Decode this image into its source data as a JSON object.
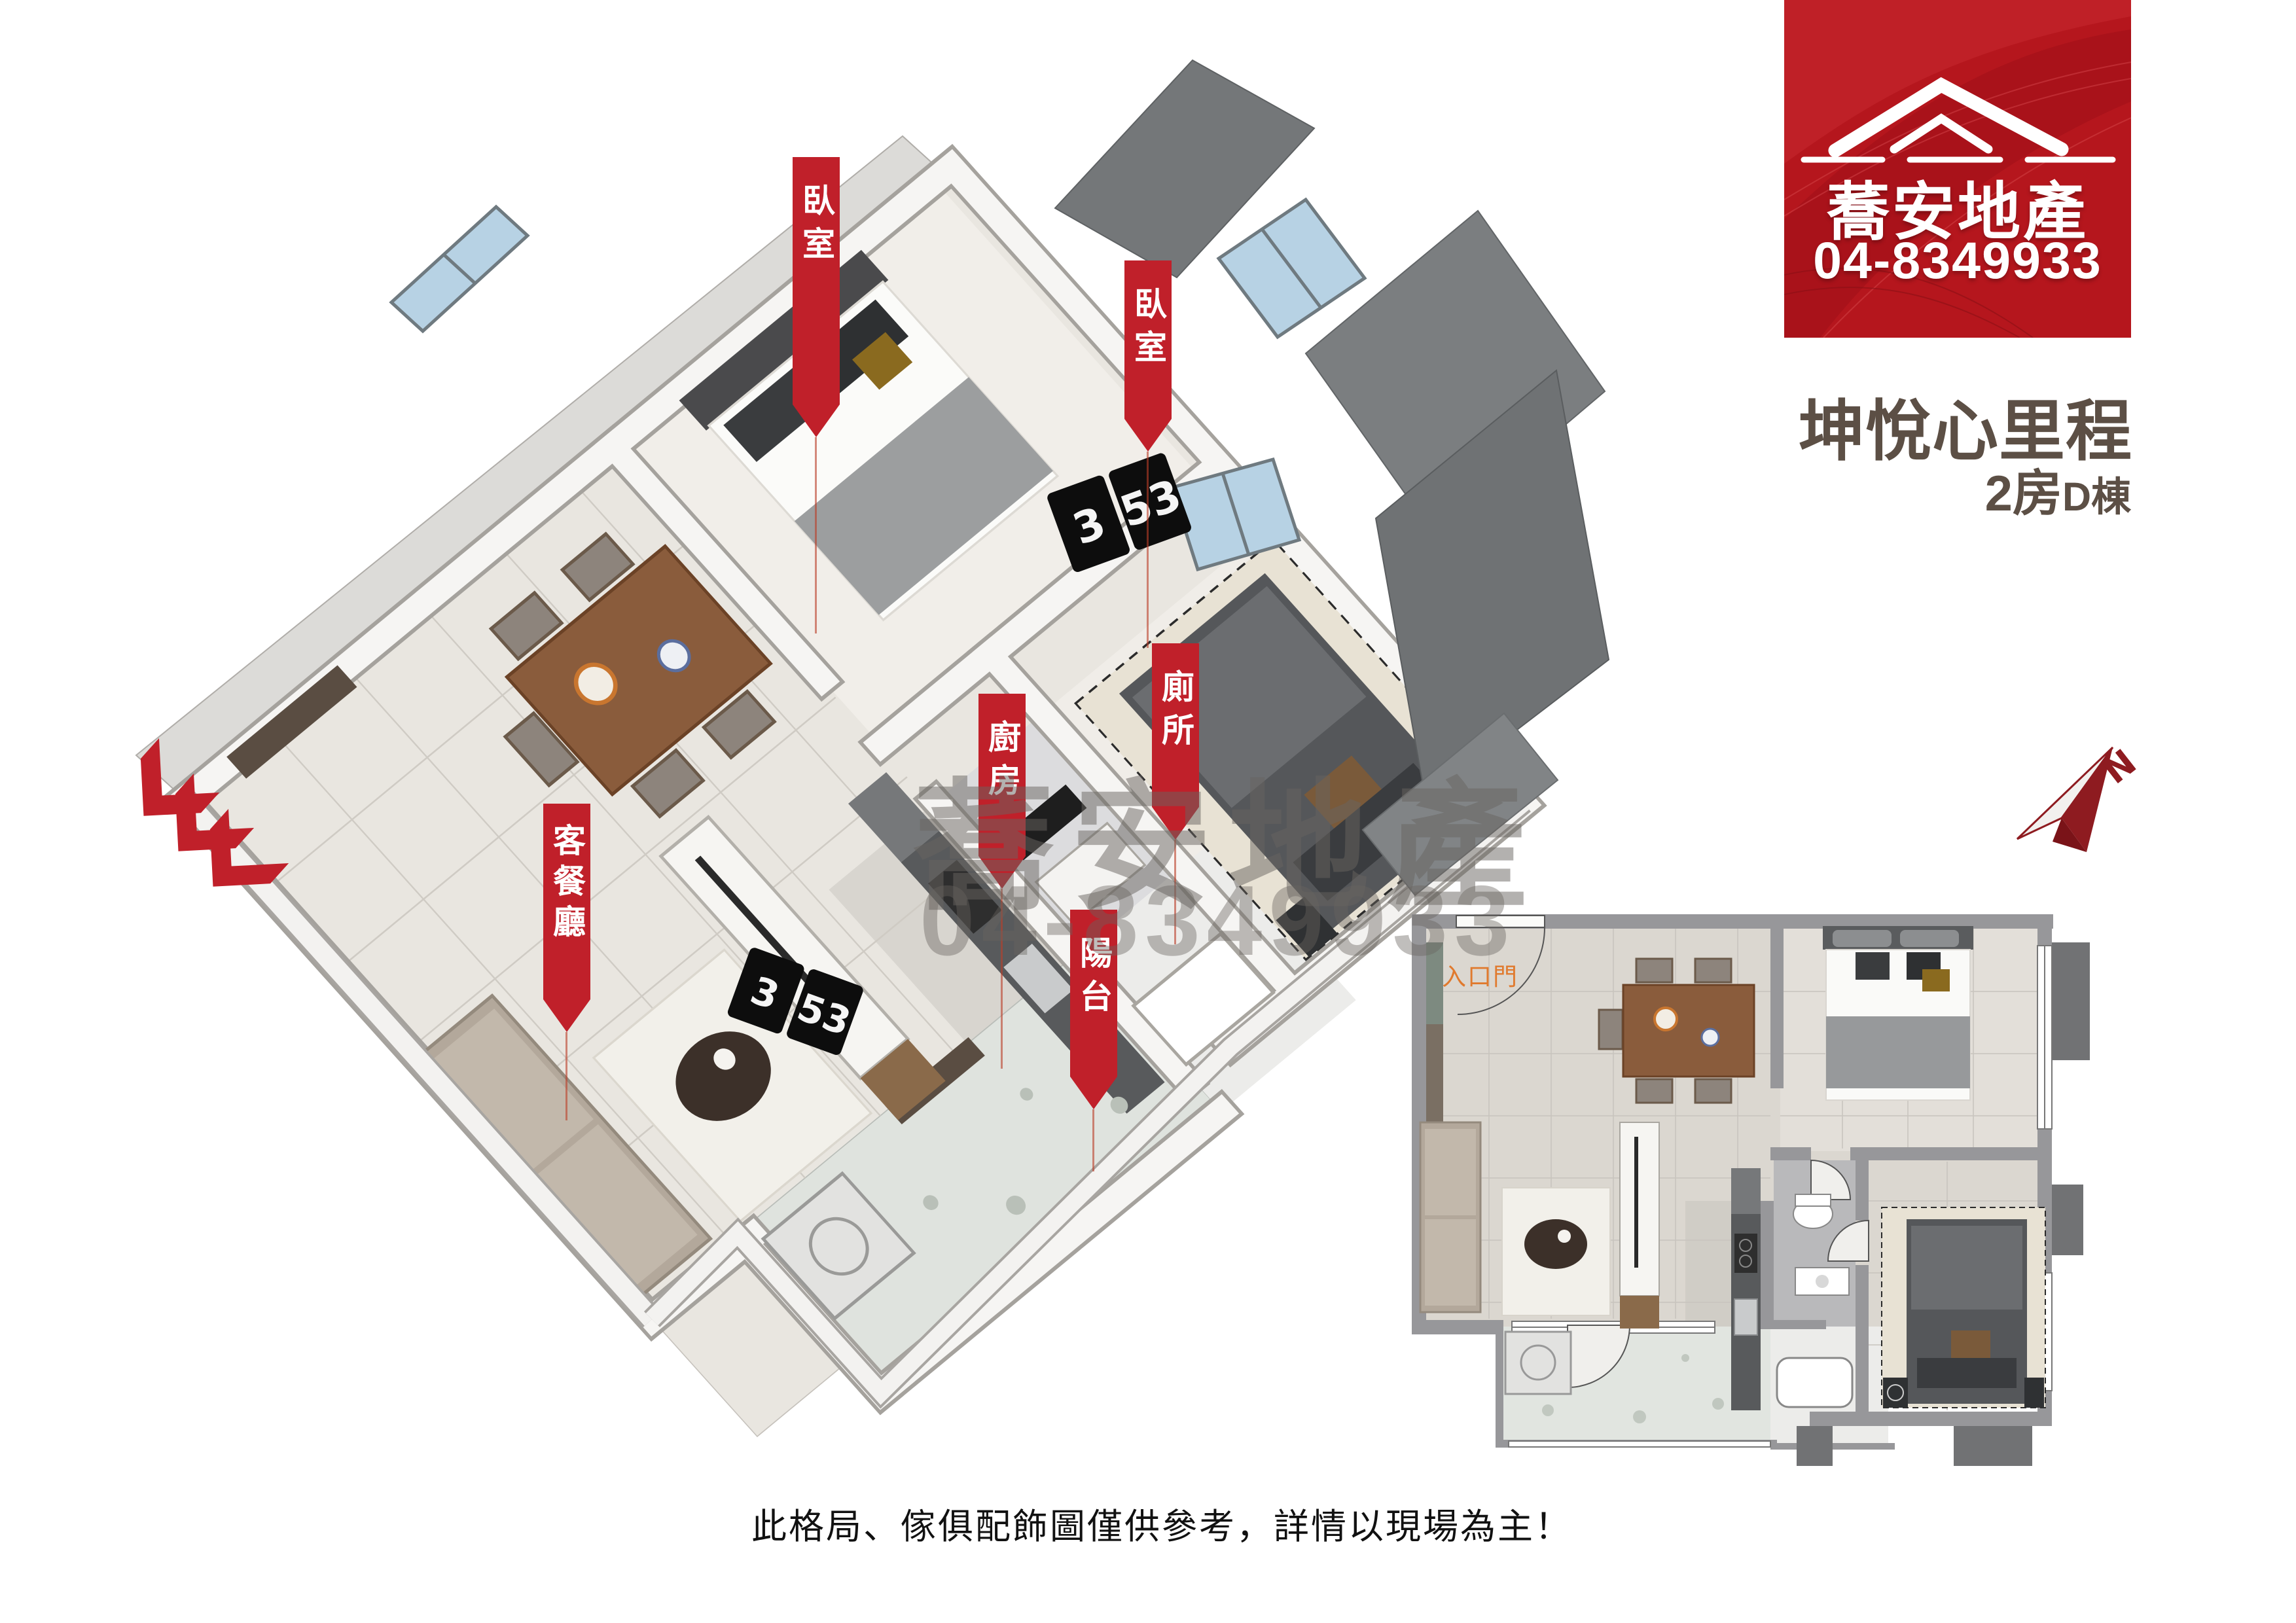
{
  "logo": {
    "brand": "蕎安地產",
    "phone": "04-8349933"
  },
  "project": {
    "name": "坤悅心里程",
    "layout": "2房",
    "building": "D棟"
  },
  "room_labels": {
    "bedroom_1": "臥室",
    "bedroom_2": "臥室",
    "toilet": "廁所",
    "kitchen": "廚房",
    "balcony": "陽台",
    "living_dining": "客餐廳"
  },
  "plan_2d": {
    "entrance_label": "入口門"
  },
  "clock": {
    "hour": "3",
    "minute": "53"
  },
  "compass": {
    "north": "N"
  },
  "watermark": {
    "brand": "蕎安地產",
    "phone": "04-8349933"
  },
  "disclaimer": "此格局、傢俱配飾圖僅供參考，詳情以現場為主！",
  "colors": {
    "brand_red": "#b5161d",
    "banner_red": "#c0202a",
    "title_brown": "#5c4f45",
    "entrance_orange": "#e07a2e",
    "slab_gray": "#75787a",
    "window_blue": "#b7d2e4"
  }
}
